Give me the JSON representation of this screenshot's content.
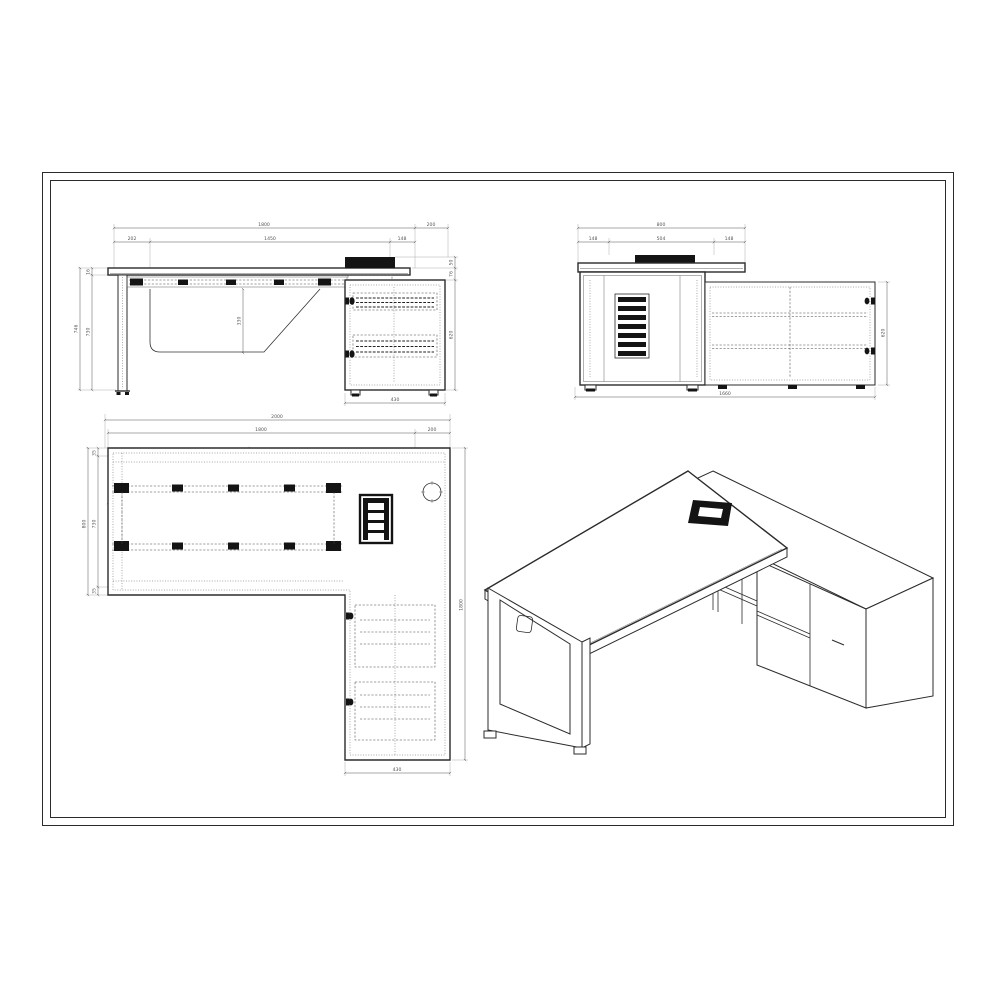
{
  "drawing": {
    "type": "technical-drawing",
    "subject": "L-shaped executive desk with return side cabinet",
    "line_color": "#2b2b2b",
    "dim_color": "#555555",
    "background": "#ffffff"
  },
  "views": {
    "front": {
      "label": "front-elevation",
      "dims": {
        "top_total": "1800",
        "top_overhang": "200",
        "seg_left": "202",
        "seg_mid": "1450",
        "seg_right": "148",
        "height_total": "746",
        "top_thickness": "16",
        "leg_height": "730",
        "support_height": "330",
        "module_height": "50",
        "gap": "76",
        "cabinet_height": "620",
        "cabinet_depth": "430"
      }
    },
    "side": {
      "label": "end-elevation",
      "dims": {
        "top_total": "800",
        "seg_left": "148",
        "seg_mid": "504",
        "seg_right": "148",
        "cabinet_height": "620",
        "cabinet_length": "1660"
      }
    },
    "plan": {
      "label": "plan-view",
      "dims": {
        "overall_width": "2000",
        "desk_width": "1800",
        "return_overhang": "200",
        "desk_depth": "800",
        "edge_top": "35",
        "inner_depth": "730",
        "edge_bottom": "35",
        "rail_offset": "143",
        "rail_length": "1365",
        "rail_gap": "330",
        "overall_depth": "1800",
        "cabinet_depth": "430"
      }
    },
    "iso": {
      "label": "isometric-view"
    }
  }
}
